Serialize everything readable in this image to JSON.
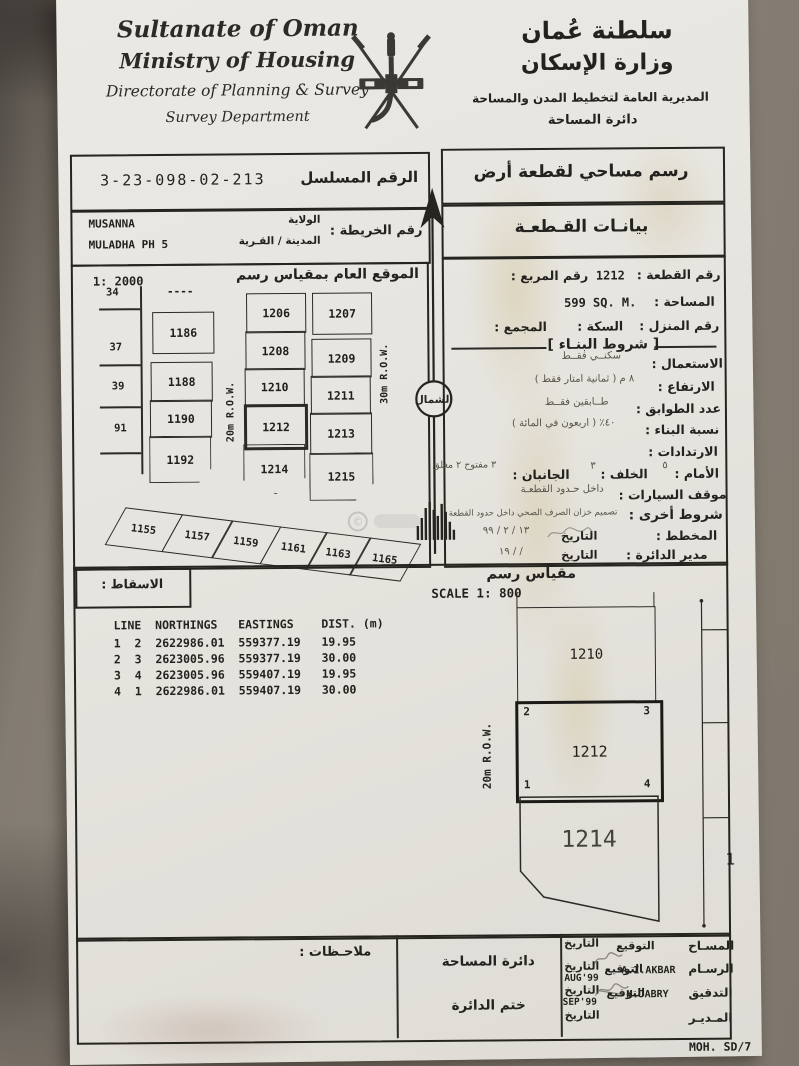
{
  "header": {
    "en_line1": "Sultanate of Oman",
    "en_line2": "Ministry of Housing",
    "en_line3": "Directorate of Planning & Survey",
    "en_line4": "Survey Department",
    "ar_line1": "سلطنة عُمان",
    "ar_line2": "وزارة الإسكان",
    "ar_line3": "المديرية العامة لتخطيط المدن والمساحة",
    "ar_line4": "دائرة المساحة"
  },
  "serial_box": {
    "label": "الرقم المسلسل",
    "value": "3-23-098-02-213"
  },
  "title_box": {
    "text": "رسم مساحي لقطعة أرض"
  },
  "map_ref_box": {
    "label": "رقم الخريطة :",
    "wilayat_label": "الولاية",
    "wilayat_value": "MUSANNA",
    "town_label": "المدينة / القـرية",
    "town_value": "MULADHA PH 5"
  },
  "plot_header_box": {
    "text": "بيانـات القـطعـة"
  },
  "location_map": {
    "title": "الموقع العام بمقياس رسم",
    "scale_text": "1: 2000",
    "top_dashes": "----",
    "street_labels": [
      "34",
      "37",
      "39",
      "91"
    ],
    "col_a": [
      "1186",
      "1188",
      "1190",
      "1192"
    ],
    "col_b": [
      "1206",
      "1208",
      "1210",
      "1212",
      "1214"
    ],
    "col_c": [
      "1207",
      "1209",
      "1211",
      "1213",
      "1215"
    ],
    "strip": [
      "1155",
      "1157",
      "1159",
      "1161",
      "1163",
      "1165"
    ],
    "row_20m": "20m R.O.W.",
    "row_30m": "30m R.O.W.",
    "north_label": "الشمال"
  },
  "plot_data": {
    "plot_no_label": "رقم القطعة :",
    "plot_no": "1212",
    "square_label": "رقم المربع :",
    "area_label": "المساحة :",
    "area": "599 SQ. M.",
    "house_label": "رقم المنزل :",
    "street_label": "السكة :",
    "complex_label": "المجمع :",
    "conditions_title": "[ شروط البنـاء ]",
    "use_label": "الاستعمال :",
    "use_value": "سكنــي فقــط",
    "height_label": "الارتفاع :",
    "height_value": "٨ م ( ثمانية امتار فقط )",
    "floors_label": "عدد الطوابق :",
    "floors_value": "طــابقين فقــط",
    "ratio_label": "نسبة البناء :",
    "ratio_value": "٤٠٪ ( اربعون في المائة )",
    "setbacks_label": "الارتدادات :",
    "front_label": "الأمام :",
    "front_value": "٥",
    "back_label": "الخلف :",
    "back_value": "٣",
    "sides_label": "الجانبان :",
    "sides_value": "٣ مفتوح ٢ مغلق",
    "parking_label": "موقف السيارات :",
    "parking_value": "داخل حـدود القطعـة",
    "other_label": "شروط أخرى :",
    "other_value": "تصميم خزان الصرف الصحي داخل حدود القطعة",
    "planner_label": "المخطط :",
    "planner_date_label": "التاريخ",
    "planner_date": "١٣ / ٢ / ٩٩",
    "director_label": "مدير الدائرة :",
    "director_date_label": "التاريخ",
    "director_date": "/ / ١٩"
  },
  "scale_section": {
    "projection_label": "الاسقاط :",
    "scale_ar": "مقياس رسم",
    "scale_en": "SCALE 1:  800"
  },
  "survey_table": {
    "header": "LINE  NORTHINGS   EASTINGS    DIST. (m)",
    "rows": [
      "1  2  2622986.01  559377.19   19.95",
      "2  3  2623005.96  559377.19   30.00",
      "3  4  2623005.96  559407.19   19.95",
      "4  1  2622986.01  559407.19   30.00"
    ]
  },
  "drawing": {
    "row_label": "20m  R.O.W.",
    "upper_plot": "1210",
    "main_plot": "1212",
    "lower_plot": "1214",
    "corner_tl": "2",
    "corner_tr": "3",
    "corner_bl": "1",
    "corner_br": "4",
    "edge_number": "1"
  },
  "footer": {
    "notes_label": "ملاحـظات :",
    "dept_label": "دائرة المساحة",
    "stamp_label": "ختم الدائرة",
    "sig_label": "التوقيع",
    "date_label": "التاريخ",
    "rows": [
      {
        "role": "المسـاح",
        "name": "",
        "date": ""
      },
      {
        "role": "الرسـام",
        "name": "A.I.AKBAR",
        "date": "AUG'99"
      },
      {
        "role": "التدقيق",
        "name": "M.JABRY",
        "date": "SEP'99"
      },
      {
        "role": "المـديـر",
        "name": "",
        "date": ""
      }
    ],
    "form_code": "MOH. SD/7"
  }
}
